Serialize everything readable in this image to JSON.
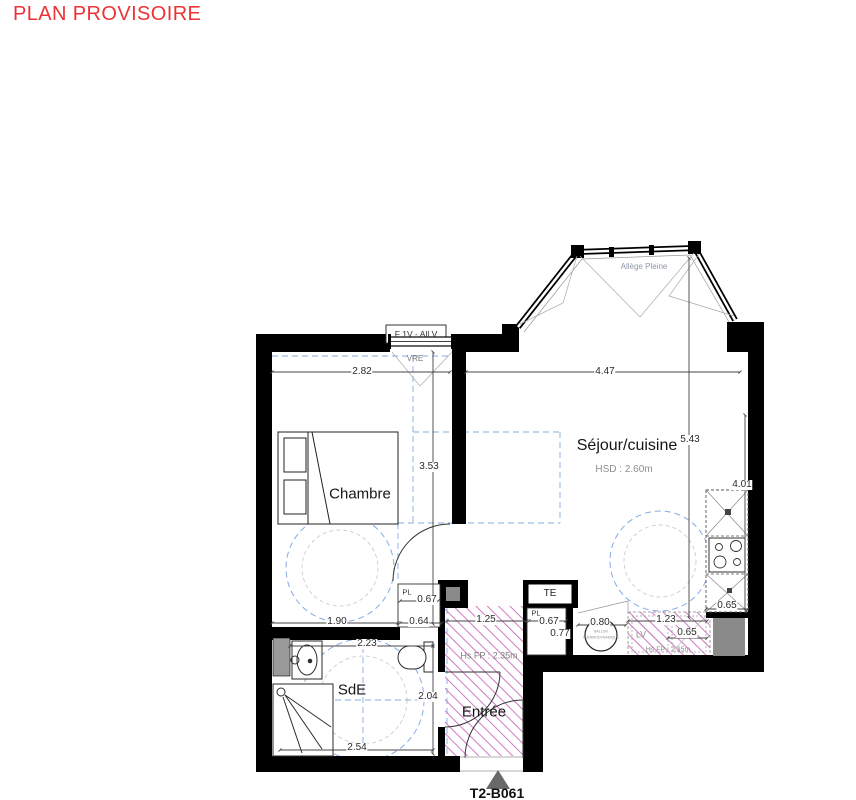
{
  "title": "PLAN PROVISOIRE",
  "plan": {
    "unit": "T2-B061",
    "rooms": {
      "chambre": {
        "name": "Chambre"
      },
      "sejour": {
        "name": "Séjour/cuisine",
        "hsd": "HSD : 2.60m"
      },
      "sde": {
        "name": "SdE"
      },
      "entree": {
        "name": "Entrée",
        "hs_fp": "Hs FP : 2.35m"
      }
    },
    "labels": {
      "window": "F 1V - All V",
      "vre": "VRE",
      "allege": "Allège Pleine",
      "te": "TE",
      "pl_left": "PL",
      "pl_right": "PL",
      "lv": "LV",
      "lv_hs_fp": "Hs FP : 2.35m",
      "ballon_1": "BALLON",
      "ballon_2": "THERMODYNAMIQUE"
    },
    "dims": {
      "chambre_width": "2.82",
      "chambre_height": "3.53",
      "sejour_width": "4.47",
      "sejour_height": "5.43",
      "kitchen_length": "4.01",
      "kitchen_depth": "0.65",
      "sde_upper": "1.90",
      "pl_left_width": "0.64",
      "pl_left_depth": "0.67",
      "entree_width": "1.25",
      "pl_right_width": "0.67",
      "pl_right_depth": "0.77",
      "ballon_width": "0.80",
      "lv_width": "1.23",
      "lv_depth": "0.65",
      "sde_width": "2.23",
      "sde_height": "2.04",
      "sde_bottom": "2.54"
    },
    "colors": {
      "title_red": "#ed3237",
      "wall_black": "#000000",
      "hatch_pink": "#cf7ac4",
      "clearance_blue": "#84abe3",
      "dim_gray": "#444444",
      "muted_gray": "#8f8f8f",
      "shaft_gray": "#8a8a8a"
    }
  }
}
